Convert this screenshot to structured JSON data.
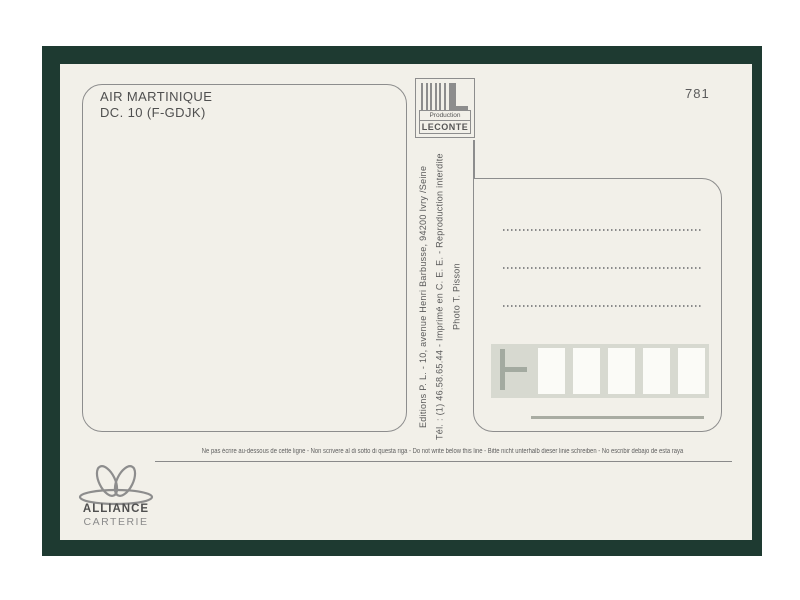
{
  "card": {
    "caption_line1": "AIR MARTINIQUE",
    "caption_line2": "DC. 10 (F-GDJK)",
    "number": "781",
    "publisher": {
      "logo_line1": "Production",
      "logo_line2": "LECONTE",
      "address_line": "Editions P. L. - 10, avenue Henri Barbusse, 94200 Ivry /Seine",
      "info_line": "Tél. : (1) 46.58.65.44 - Imprimé en C. E. E. - Reproduction interdite",
      "photo_credit": "Photo T. Pisson"
    },
    "address": {
      "dotted_line_count": 3,
      "postal_box_count": 5
    },
    "divider_note": "Ne pas écrire au-dessous de cette ligne - Non scrivere al di sotto di questa riga - Do not write below this line - Bitte nicht unterhalb dieser linie schreiben - No escribir debajo de esta raya",
    "brand": {
      "name": "ALLIANCE",
      "subtitle": "CARTERIE"
    },
    "colors": {
      "frame": "#1e3a31",
      "paper": "#f2f0e9",
      "line": "#8d8d8d",
      "band": "#d7d9d0"
    }
  }
}
